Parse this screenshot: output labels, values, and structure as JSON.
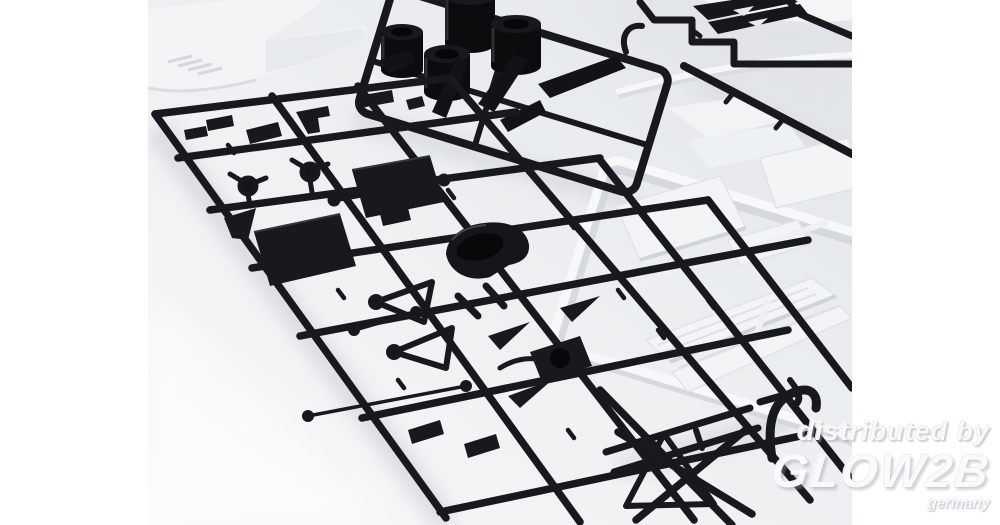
{
  "watermark": {
    "prefix": "distributed by",
    "brand": "GLOW2B",
    "country": "germany"
  },
  "palette": {
    "canvas_white": "#ffffff",
    "surface_top": "#e3e6e9",
    "surface_bottom": "#f7f8fa",
    "plastic_black": "#17191c",
    "plastic_black_deep": "#0a0c0e",
    "plastic_white": "#f2f4f6",
    "plastic_white_shadow": "#d5d9dd",
    "cast_shadow": "#bfc4ca",
    "watermark_white": "#fcfdfe"
  }
}
